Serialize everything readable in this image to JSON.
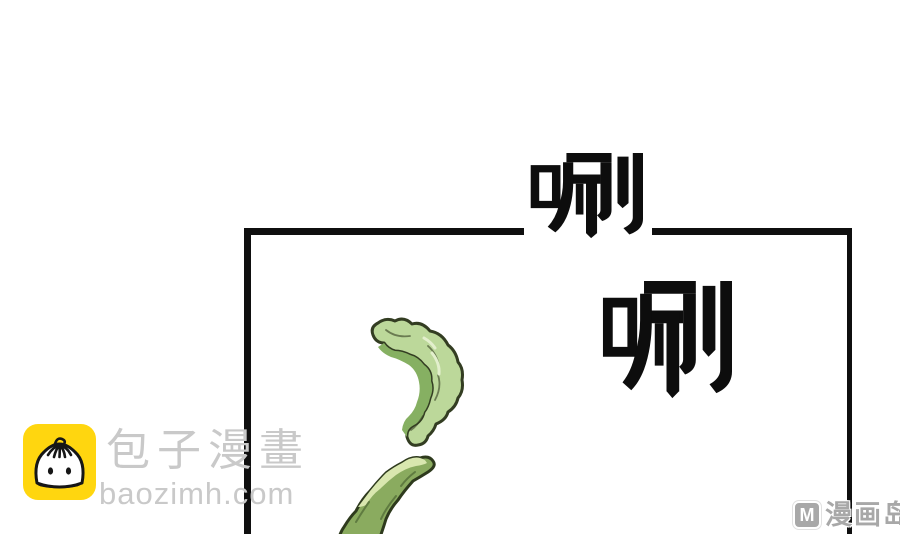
{
  "page": {
    "type": "comic-page",
    "background": "#ffffff"
  },
  "sound_effects": {
    "outer": "唰",
    "inner": "唰",
    "color": "#0d0d0d"
  },
  "panel": {
    "border_color": "#0f0f0f"
  },
  "artwork": {
    "items": [
      {
        "name": "vegetable-crescent",
        "description": "curled light-green vegetable peel inside panel",
        "colors": {
          "body": "#bcd89a",
          "inner_face": "#86b062",
          "highlight": "#e3efcd",
          "outline": "#333d22"
        }
      },
      {
        "name": "vegetable-pod",
        "description": "green pod rising from bottom edge of panel",
        "colors": {
          "body": "#8aab5f",
          "highlight": "#d9e7af",
          "outline": "#2e3a1d",
          "vein": "#5f7b40"
        }
      }
    ]
  },
  "watermarks": {
    "baozi": {
      "brand": "包子漫畫",
      "domain": "baozimh.com",
      "text_color": "#c9c9c9",
      "icon": {
        "name": "bao-bun-icon",
        "background": "#ffd60f",
        "line_color": "#161616"
      }
    },
    "manhuadao": {
      "badge": "M",
      "title": "漫画岛",
      "color": "#a8a8a8"
    }
  }
}
